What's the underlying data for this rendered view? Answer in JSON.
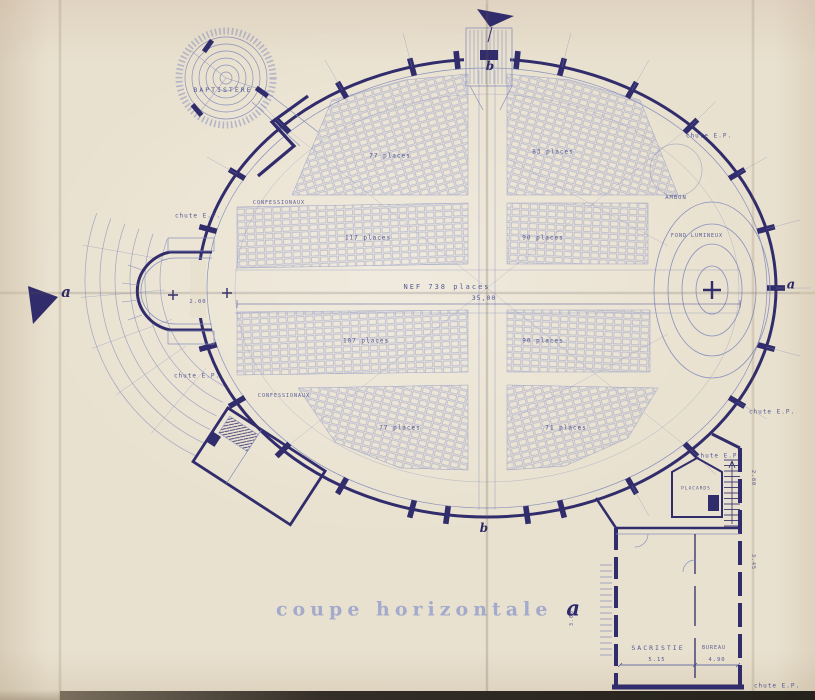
{
  "meta": {
    "drawing_type": "architectural plan, elliptical church",
    "title": "coupe horizontale",
    "title_marker": "a"
  },
  "colors": {
    "paper": "#e9e1cf",
    "ink_dark": "#312c6b",
    "ink_light": "#8890bd",
    "label_blue": "#44498f",
    "title_blue": "#98a1cb"
  },
  "markers": {
    "a": "a",
    "b": "b"
  },
  "labels": {
    "baptistere": "BAPTISTÈRE",
    "chute_ep": "chute E.P.",
    "confessionaux": "CONFESSIONAUX",
    "ambon": "AMBON",
    "fond_lumineux": "FOND LUMINEUX",
    "nef": "NEF  738 places",
    "sacristie": "SACRISTIE",
    "bureau": "BUREAU",
    "placards": "PLACARDS"
  },
  "dimensions": {
    "nave_width": "35,00",
    "aisle": "2.00",
    "sacristie_width": "5.15",
    "bureau_width": "4.90",
    "annex_left": "3.60",
    "annex_right_low": "3.45",
    "annex_right_high": "2.80"
  },
  "seating": [
    {
      "id": "upper-left",
      "label": "77 places"
    },
    {
      "id": "upper-right",
      "label": "83 places"
    },
    {
      "id": "mid-left",
      "label": "117 places"
    },
    {
      "id": "mid-right",
      "label": "90 places"
    },
    {
      "id": "lower-left",
      "label": "107 places"
    },
    {
      "id": "lower-right",
      "label": "90 places"
    },
    {
      "id": "bottom-left",
      "label": "77 places"
    },
    {
      "id": "bottom-right",
      "label": "71 places"
    }
  ]
}
